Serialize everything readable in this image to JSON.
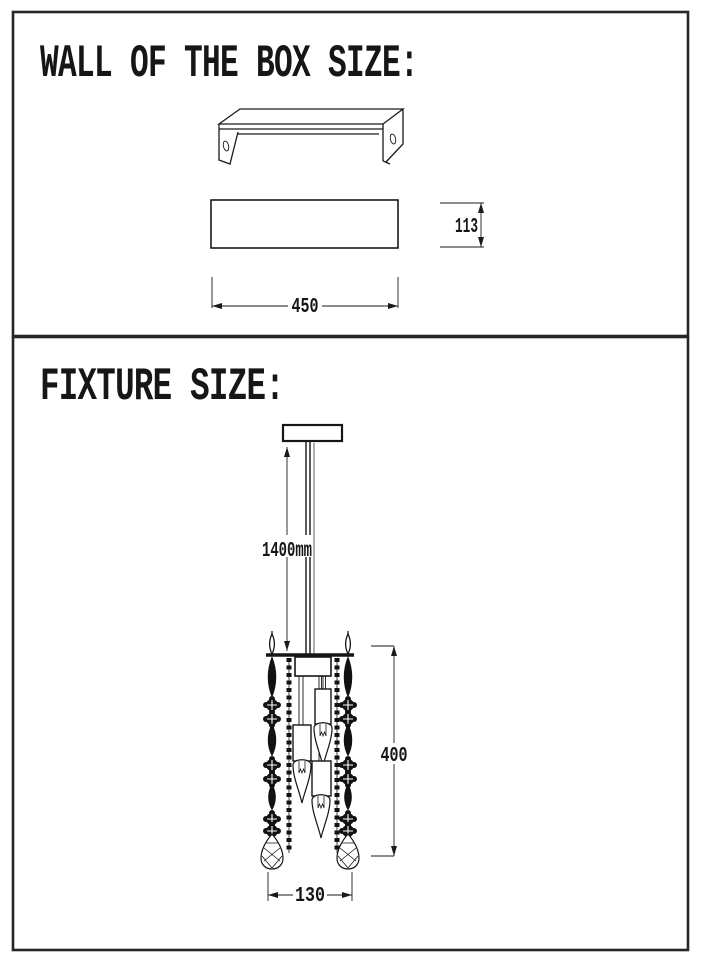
{
  "page": {
    "background_color": "#ffffff",
    "line_color": "#1a1a1a"
  },
  "sections": {
    "wall_box": {
      "title": "WALL OF THE BOX SIZE:",
      "dims": {
        "width": "450",
        "height": "113"
      }
    },
    "fixture": {
      "title": "FIXTURE SIZE:",
      "dims": {
        "drop": "1400mm",
        "height": "400",
        "width": "130"
      }
    }
  }
}
